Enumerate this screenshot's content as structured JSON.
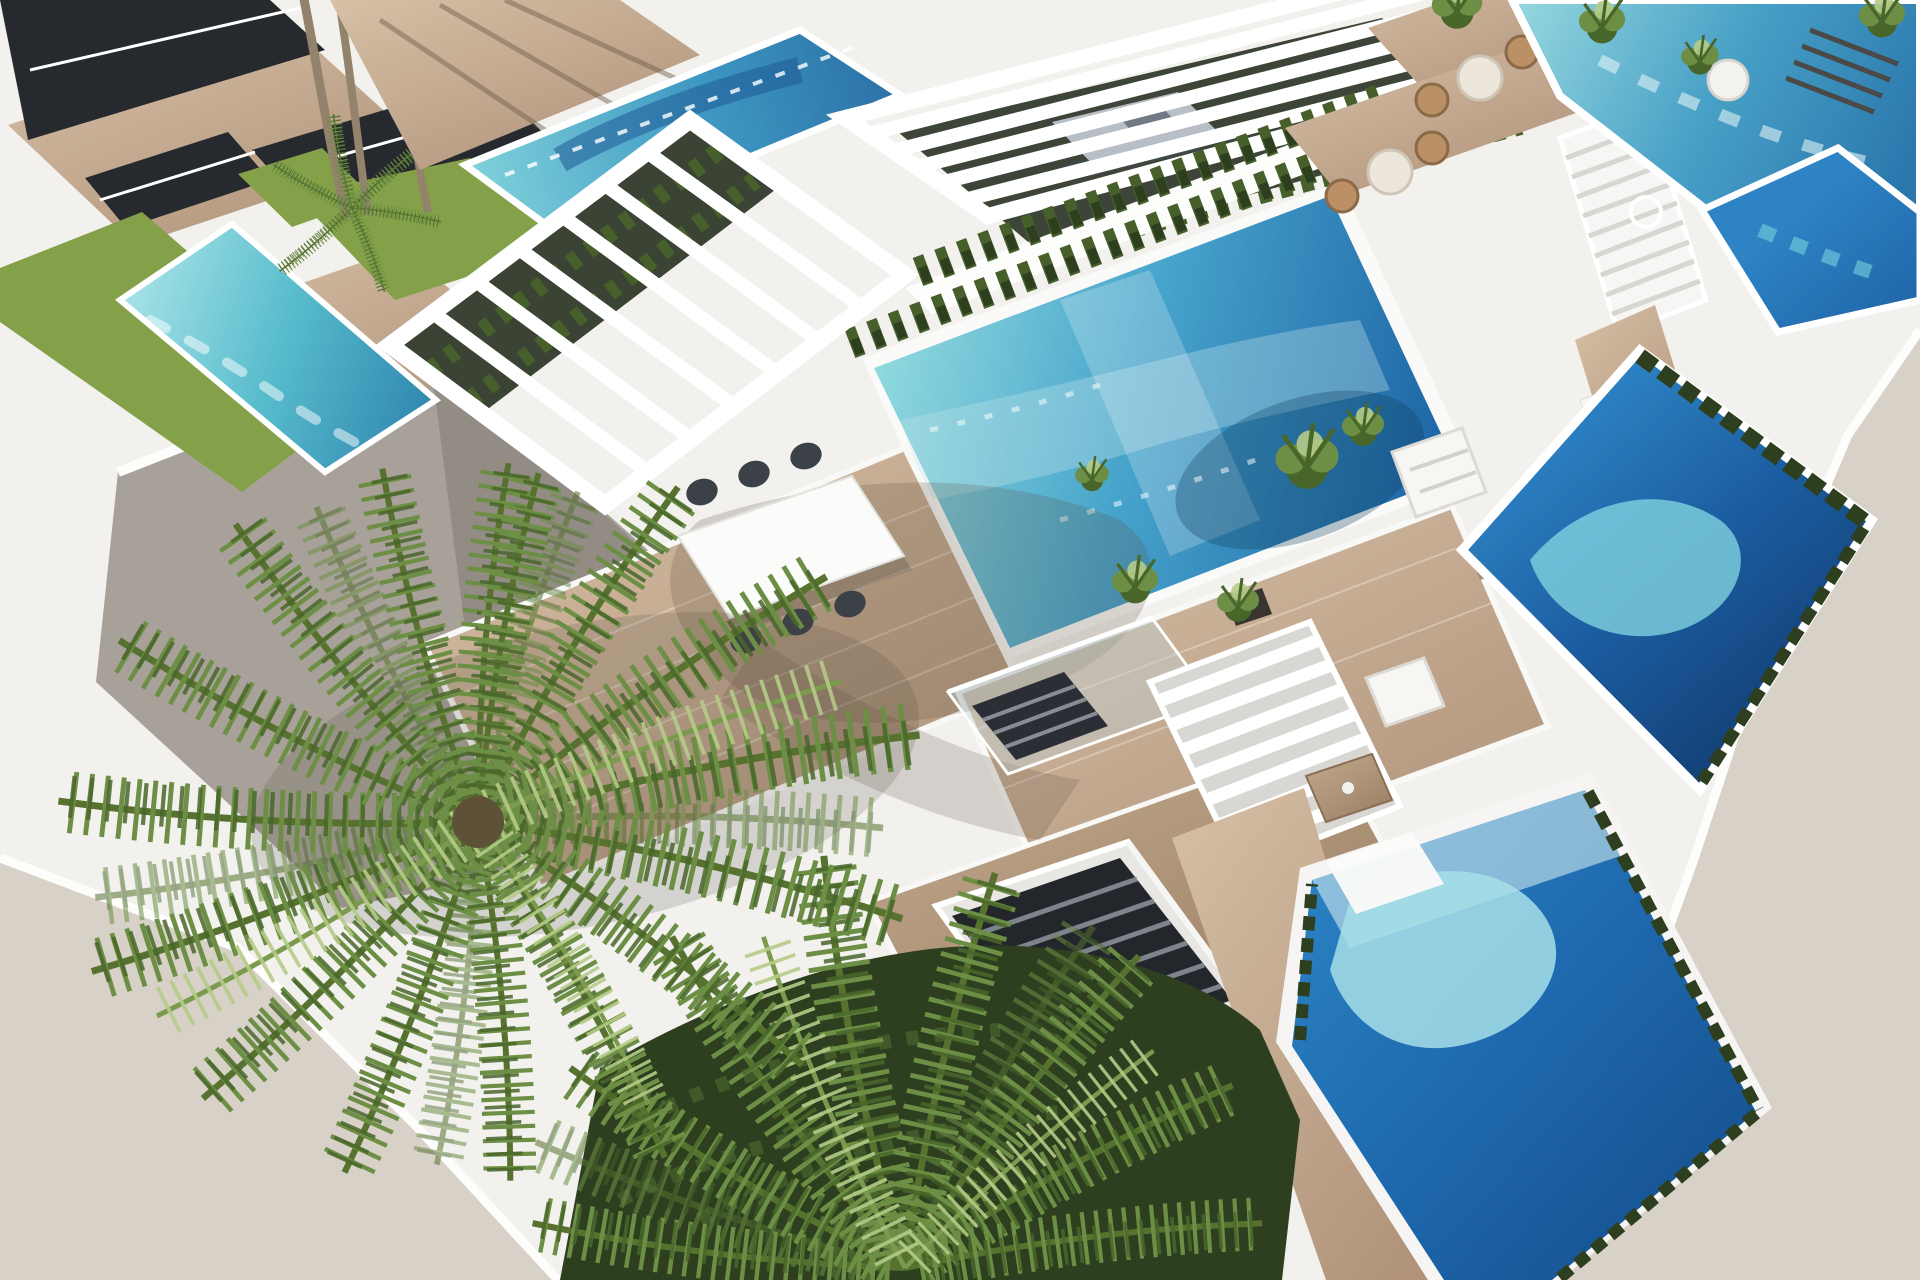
{
  "scene": {
    "type": "3d-architectural-render",
    "view": "aerial-oblique",
    "description": "Aerial 3D rendering of a modern white villa development: rows of flat-roofed terraced villas with private rectangular swimming pools, white slatted pergolas, wooden sun decks, an outdoor dining table with dark chairs, rattan bistro sets, sun loungers, cypress hedges, lawns, external white staircases and a large foreground palm tree over a grey paved patio on a plain beige ground.",
    "objects": [
      {
        "name": "villa-top-left",
        "label": "Two-storey villa with dark glazed walls and wooden decks"
      },
      {
        "name": "villa-top-left-pool",
        "label": "Turquoise strip pool with lawn surround"
      },
      {
        "name": "upper-pool",
        "label": "Upper villa pool with glass fence"
      },
      {
        "name": "pergola-main",
        "label": "Large white slatted pergola over the main deck"
      },
      {
        "name": "pergola-back",
        "label": "White slatted pergola over shaded garden"
      },
      {
        "name": "daybed",
        "label": "Grey outdoor daybed"
      },
      {
        "name": "central-pool",
        "label": "Main turquoise-to-blue swimming pool"
      },
      {
        "name": "hedge-rows",
        "label": "Rows of clipped shrubs along pool wall"
      },
      {
        "name": "main-deck",
        "label": "Timber roof deck"
      },
      {
        "name": "dining-set",
        "label": "White dining table with six dark chairs"
      },
      {
        "name": "stair-void",
        "label": "Glass-railed stair opening in deck"
      },
      {
        "name": "basement-stair",
        "label": "Dark stair descending to lower level"
      },
      {
        "name": "bistro-sets",
        "label": "Two rattan bistro sets on roof terraces"
      },
      {
        "name": "exterior-stair-upper",
        "label": "White exterior staircase"
      },
      {
        "name": "exterior-stair-mid",
        "label": "Open-riser white staircase"
      },
      {
        "name": "lounge-set",
        "label": "White lounge sofa with timber coffee table"
      },
      {
        "name": "right-pool",
        "label": "Deep blue pool with hedge border"
      },
      {
        "name": "top-right-pool",
        "label": "Corner pool at top right"
      },
      {
        "name": "bottom-pool",
        "label": "Bright blue pool with cyan shallows"
      },
      {
        "name": "palm-main",
        "label": "Large foreground palm tree"
      },
      {
        "name": "palm-lower",
        "label": "Second palm at bottom"
      },
      {
        "name": "palm-trunks",
        "label": "Slender palm trunks by upper villa"
      },
      {
        "name": "patio-grey",
        "label": "Grey paved patio"
      },
      {
        "name": "hedge-mass",
        "label": "Dense dark garden hedge"
      },
      {
        "name": "ground",
        "label": "Plain beige ground plane"
      }
    ]
  },
  "colors": {
    "bgBeige": "#d7d1c8",
    "renderWhite": "#f2f1ee",
    "brightWhite": "#fdfdfc",
    "shadowWhite": "#e4e3df",
    "deepShade": "#d6d5d1",
    "glassDark": "#26292d",
    "woodLight": "#d6c0a6",
    "woodMid": "#b0937a",
    "patioGrey": "#a8a199",
    "patioGreyDark": "#8f8982",
    "lawnGreen": "#84a149",
    "hedgeMid": "#47602b",
    "hedgeDark": "#2e3f20",
    "palmGreen": "#6d8f45",
    "palmDark": "#49662a",
    "palmLight": "#b5cb87",
    "trunkBrown": "#93826c",
    "waterPale": "#a6dfe7",
    "waterTurquoise": "#56c3d4",
    "waterMid": "#2f86c8",
    "waterDeep": "#1b5da1",
    "waterNavy": "#123f73",
    "chairDark": "#3b4147",
    "daybedGrey": "#b8bec6",
    "rattanTan": "#bb9064",
    "tableWhite": "#fbfbf9"
  }
}
